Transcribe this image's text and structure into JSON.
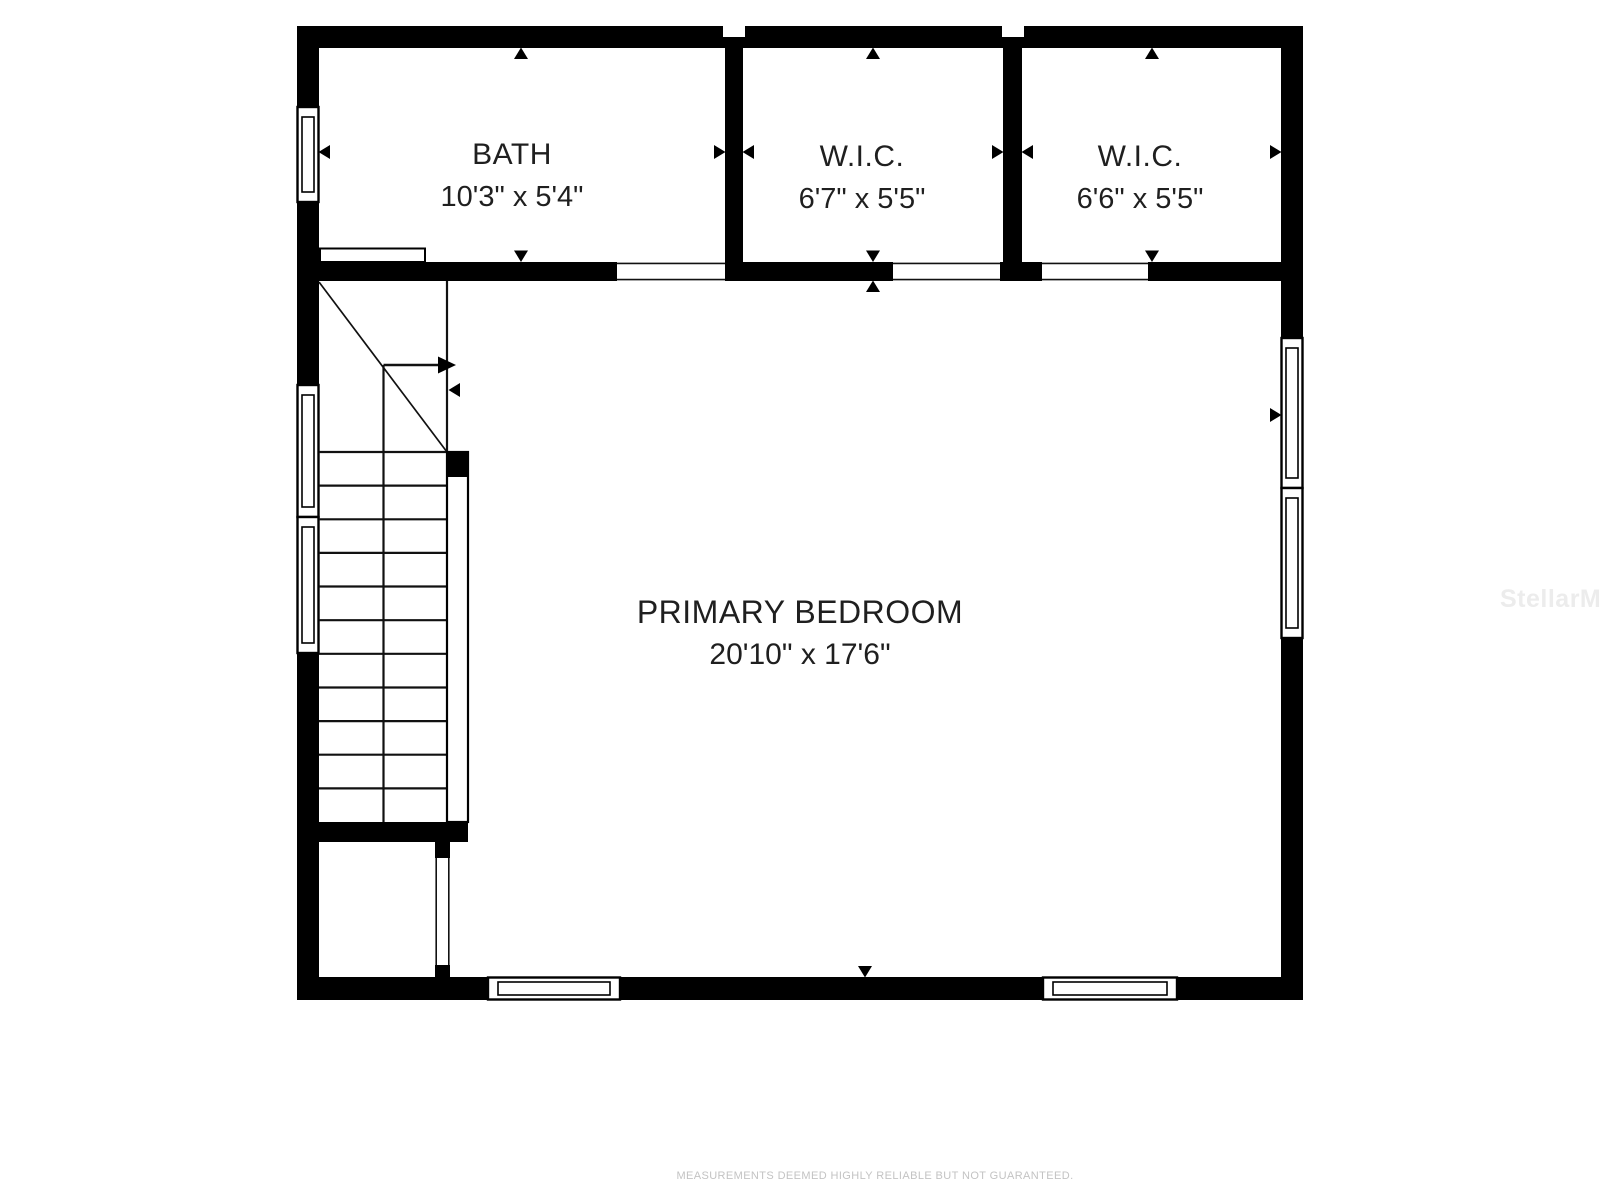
{
  "rooms": [
    {
      "name": "BATH",
      "dimensions": "10'3\" x 5'4\""
    },
    {
      "name": "W.I.C.",
      "dimensions": "6'7\" x 5'5\""
    },
    {
      "name": "W.I.C.",
      "dimensions": "6'6\" x 5'5\""
    },
    {
      "name": "PRIMARY BEDROOM",
      "dimensions": "20'10\" x 17'6\""
    }
  ],
  "watermark": "StellarMLS",
  "disclaimer": "MEASUREMENTS DEEMED HIGHLY RELIABLE BUT NOT GUARANTEED.",
  "colors": {
    "wall": "#000000",
    "label_text": "#1f1f1f",
    "disclaimer_text": "#c3c3c3",
    "watermark_text": "#ececec",
    "background": "#ffffff"
  }
}
